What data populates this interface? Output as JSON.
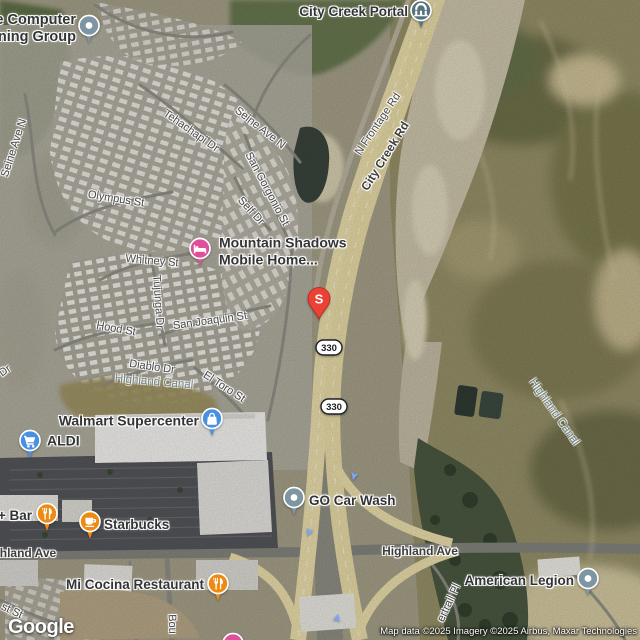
{
  "map": {
    "google_logo": "Google",
    "attribution": "Map data ©2025 Imagery ©2025 Airbus, Maxar Technologies",
    "colors": {
      "food": "#ee8a12",
      "lodging": "#e0509a",
      "shopping": "#4a90e2",
      "generic": "#7e95a4",
      "attraction": "#54737f",
      "marker": "#ea4335",
      "arrow": "#7aa5f7",
      "shield_text": "#202124"
    },
    "marker": {
      "letter": "S",
      "x": 319,
      "y": 299
    },
    "route_shields": [
      {
        "text": "330",
        "x": 329,
        "y": 347
      },
      {
        "text": "330",
        "x": 334,
        "y": 406
      }
    ],
    "direction_arrows": [
      {
        "x": 354,
        "y": 476,
        "rot": 195
      },
      {
        "x": 309,
        "y": 532,
        "rot": 200
      },
      {
        "x": 337,
        "y": 618,
        "rot": 15
      }
    ],
    "labels": {
      "streets": [
        {
          "id": "seine-ave-n-left",
          "text": "Seine Ave N",
          "x": 14,
          "y": 148,
          "rot": -72,
          "style": "road"
        },
        {
          "id": "tehachapi-dr",
          "text": "Tehachapi Dr",
          "x": 191,
          "y": 131,
          "rot": 35,
          "style": "road"
        },
        {
          "id": "seine-ave-n-right",
          "text": "Seine Ave N",
          "x": 260,
          "y": 128,
          "rot": 38,
          "style": "road"
        },
        {
          "id": "san-gorgonio-st",
          "text": "San Gorgonio St",
          "x": 267,
          "y": 189,
          "rot": 62,
          "style": "road"
        },
        {
          "id": "self-dr",
          "text": "Self Dr",
          "x": 251,
          "y": 211,
          "rot": 47,
          "style": "road"
        },
        {
          "id": "olympus-st",
          "text": "Olympus St",
          "x": 116,
          "y": 199,
          "rot": 9,
          "style": "road"
        },
        {
          "id": "whitney-st",
          "text": "Whitney St",
          "x": 152,
          "y": 261,
          "rot": 5,
          "style": "road"
        },
        {
          "id": "tujunga-dr",
          "text": "Tujunga Dr",
          "x": 158,
          "y": 302,
          "rot": 86,
          "style": "road"
        },
        {
          "id": "hood-st",
          "text": "Hood St",
          "x": 116,
          "y": 329,
          "rot": 10,
          "style": "road"
        },
        {
          "id": "san-joaquin-st",
          "text": "San Joaquin St",
          "x": 210,
          "y": 321,
          "rot": -8,
          "style": "road"
        },
        {
          "id": "diablo-dr",
          "text": "Diablo Dr",
          "x": 152,
          "y": 367,
          "rot": 8,
          "style": "road"
        },
        {
          "id": "el-toro-st",
          "text": "El Toro St",
          "x": 224,
          "y": 387,
          "rot": 33,
          "style": "road"
        },
        {
          "id": "dr-cut",
          "text": "Dr",
          "x": 5,
          "y": 371,
          "rot": -35,
          "style": "road"
        },
        {
          "id": "highland-canal-left",
          "text": "Highland Canal",
          "x": 154,
          "y": 382,
          "rot": 5,
          "style": "water"
        },
        {
          "id": "highland-canal-right",
          "text": "Highland Canal",
          "x": 554,
          "y": 412,
          "rot": 55,
          "style": "water"
        },
        {
          "id": "n-frontage-rd",
          "text": "N Frontage Rd",
          "x": 378,
          "y": 124,
          "rot": -56,
          "style": "road"
        },
        {
          "id": "city-creek-rd",
          "text": "City Creek Rd",
          "x": 385,
          "y": 156,
          "rot": -58,
          "style": "road-bold"
        },
        {
          "id": "highland-ave-left",
          "text": "hland Ave",
          "x": 28,
          "y": 553,
          "rot": 0,
          "style": "road-bold"
        },
        {
          "id": "highland-ave-right",
          "text": "Highland Ave",
          "x": 420,
          "y": 551,
          "rot": 0,
          "style": "road-bold"
        },
        {
          "id": "st-st",
          "text": "st St",
          "x": 12,
          "y": 611,
          "rot": 25,
          "style": "road"
        },
        {
          "id": "boulder-ave",
          "text": "Bou",
          "x": 172,
          "y": 624,
          "rot": 88,
          "style": "road"
        },
        {
          "id": "ertrail-pl",
          "text": "ertrail Pl",
          "x": 449,
          "y": 603,
          "rot": -65,
          "style": "road"
        }
      ],
      "pois": [
        {
          "id": "computer-training-group",
          "lines": [
            "le Computer",
            "aining Group"
          ],
          "align": "right",
          "tx": 76,
          "ty": 29,
          "fs": 14.5,
          "icon": "generic-poi",
          "ix": 89,
          "iy": 25
        },
        {
          "id": "city-creek-portal",
          "text": "City Creek Portal",
          "align": "right",
          "tx": 408,
          "ty": 12,
          "fs": 13.5,
          "icon": "attraction-pin",
          "ix": 421,
          "iy": 10
        },
        {
          "id": "mountain-shadows",
          "lines": [
            "Mountain Shadows",
            "Mobile Home..."
          ],
          "align": "left",
          "tx": 219,
          "ty": 251,
          "fs": 14,
          "icon": "lodging-pin",
          "ix": 200,
          "iy": 248
        },
        {
          "id": "walmart-supercenter",
          "text": "Walmart Supercenter",
          "align": "right",
          "tx": 199,
          "ty": 421,
          "fs": 14,
          "icon": "shopping-bag",
          "ix": 212,
          "iy": 418
        },
        {
          "id": "aldi",
          "text": "ALDI",
          "align": "left",
          "tx": 47,
          "ty": 441,
          "fs": 14,
          "icon": "shopping-cart",
          "ix": 30,
          "iy": 440
        },
        {
          "id": "plus-bar",
          "text": "+ Bar",
          "align": "right",
          "tx": 32,
          "ty": 516,
          "fs": 13.5,
          "icon": "restaurant-pin",
          "ix": 47,
          "iy": 513
        },
        {
          "id": "starbucks",
          "text": "Starbucks",
          "align": "left",
          "tx": 104,
          "ty": 525,
          "fs": 13.5,
          "icon": "coffee-pin",
          "ix": 90,
          "iy": 521
        },
        {
          "id": "mi-cocina-restaurant",
          "text": "Mi Cocina Restaurant",
          "align": "right",
          "tx": 204,
          "ty": 585,
          "fs": 13.5,
          "icon": "restaurant-pin",
          "ix": 218,
          "iy": 583
        },
        {
          "id": "go-car-wash",
          "text": "GO Car Wash",
          "align": "left",
          "tx": 309,
          "ty": 501,
          "fs": 13.5,
          "icon": "generic-poi",
          "ix": 294,
          "iy": 497
        },
        {
          "id": "american-legion",
          "text": "American Legion",
          "align": "right",
          "tx": 574,
          "ty": 581,
          "fs": 13.5,
          "icon": "generic-poi",
          "ix": 588,
          "iy": 578
        },
        {
          "id": "lodging-clipped",
          "icon": "lodging-pin",
          "ix": 233,
          "iy": 643
        }
      ]
    }
  }
}
